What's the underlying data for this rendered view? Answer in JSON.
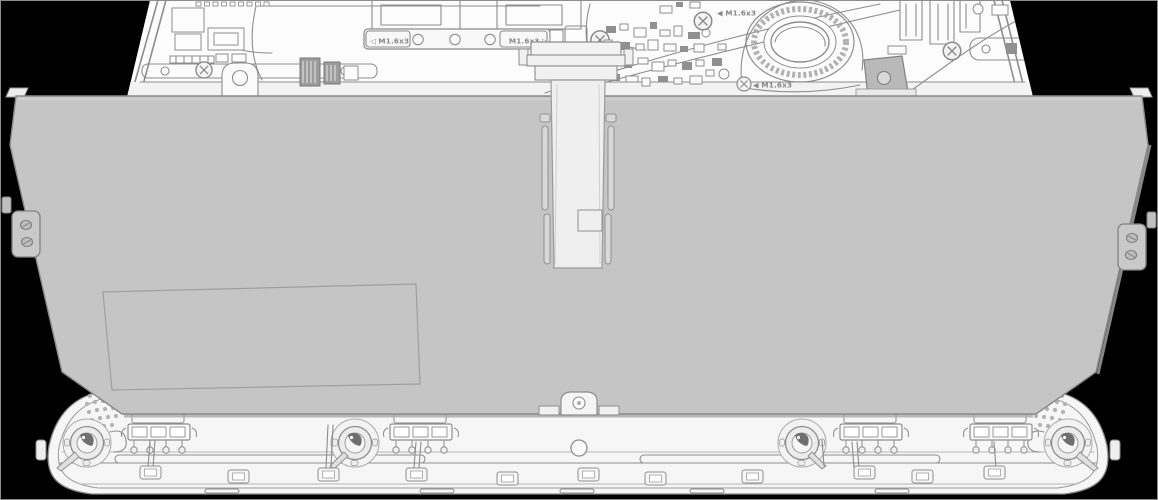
{
  "callouts": {
    "bracket_screw_left": "◁ M1.6x3",
    "bracket_screw_right": "M1.6x3 ▷",
    "board_screw_top": "◀ M1.6x3",
    "fan_screw": "◀ M1.6x3"
  },
  "colors": {
    "background": "#000000",
    "outline": "#8d8d8d",
    "battery_fill": "#c5c5c5",
    "chassis_fill": "#f6f6f6",
    "panel_fill": "#fcfcfc",
    "dark_accent": "#6f6f6f"
  }
}
